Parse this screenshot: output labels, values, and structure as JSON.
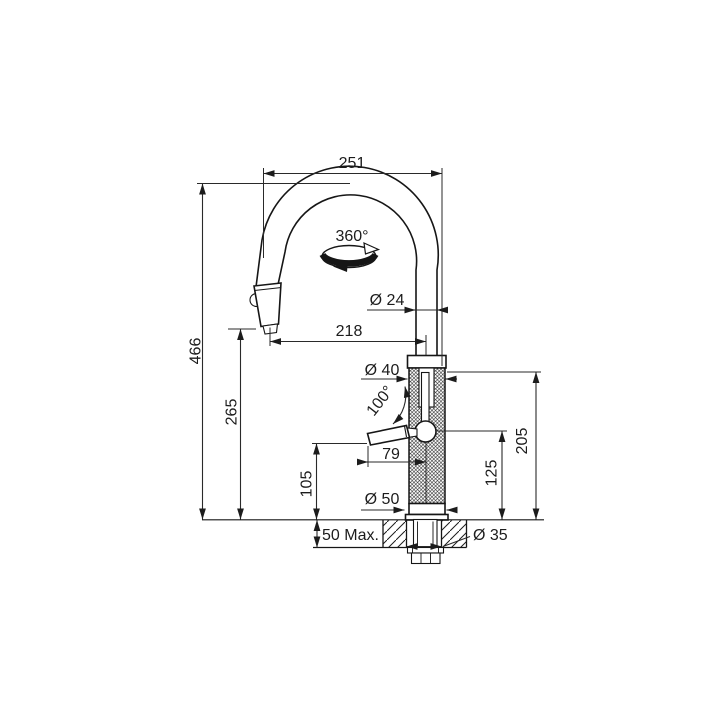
{
  "drawing": {
    "labels": {
      "spout_width": "251",
      "swivel_angle": "360°",
      "spout_diameter": "Ø 24",
      "spout_reach": "218",
      "overall_height": "466",
      "outlet_height": "265",
      "body_diameter": "Ø 40",
      "lever_swing_angle": "100°",
      "lever_length": "79",
      "lever_height": "105",
      "upper_body_height": "125",
      "body_height": "205",
      "base_diameter": "Ø 50",
      "max_counter_thickness": "50 Max.",
      "mounting_hole_diameter": "Ø 35"
    },
    "colors": {
      "line": "#1c1c1c",
      "background": "#ffffff"
    }
  }
}
